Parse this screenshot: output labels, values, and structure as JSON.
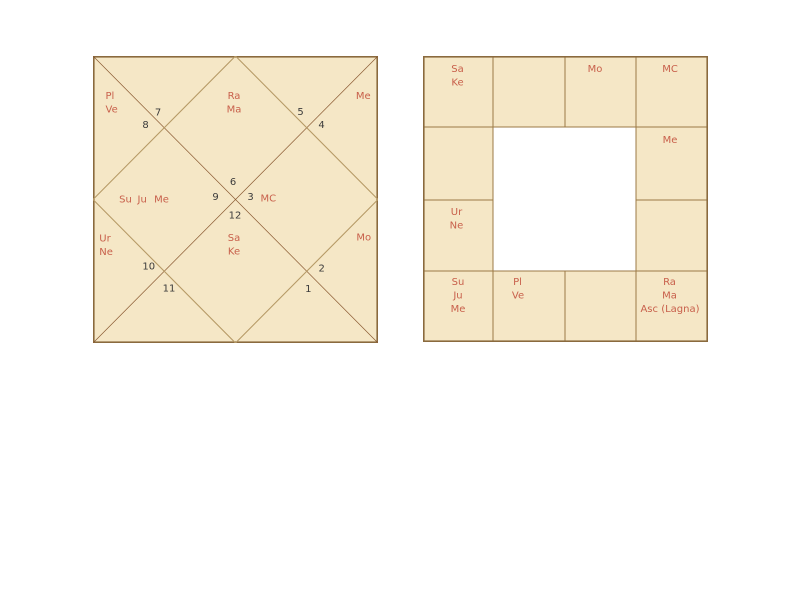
{
  "page": {
    "background": "#ffffff"
  },
  "colors": {
    "chart_fill": "#f5e7c6",
    "outer_border": "#8a6a3e",
    "grid_line": "#9b7a45",
    "diagonal_line": "#8a5a32",
    "rhombus_line": "#b69a66",
    "planet_text": "#c8604b",
    "number_text": "#3b3b3b"
  },
  "north_chart": {
    "house_numbers": {
      "h7": "7",
      "h8": "8",
      "h5": "5",
      "h4": "4",
      "h6": "6",
      "h9": "9",
      "h3": "3",
      "h12": "12",
      "h10": "10",
      "h11": "11",
      "h2": "2",
      "h1": "1"
    },
    "placements": {
      "top_left": [
        "Pl",
        "Ve"
      ],
      "top_center": [
        "Ra",
        "Ma"
      ],
      "top_right": [
        "Me"
      ],
      "left": [
        "Su",
        "Ju",
        "Me"
      ],
      "center_right": [
        "MC"
      ],
      "bottom_left": [
        "Ur",
        "Ne"
      ],
      "bottom_center": [
        "Sa",
        "Ke"
      ],
      "bottom_right": [
        "Mo"
      ]
    }
  },
  "south_chart": {
    "cells": {
      "r0c0": [
        "Sa",
        "Ke"
      ],
      "r0c2": [
        "Mo"
      ],
      "r0c3": [
        "MC"
      ],
      "r1c3": [
        "Me"
      ],
      "r2c0": [
        "Ur",
        "Ne"
      ],
      "r3c0": [
        "Su",
        "Ju",
        "Me"
      ],
      "r3c1": [
        "Pl",
        "Ve"
      ],
      "r3c3": [
        "Ra",
        "Ma",
        "Asc (Lagna)"
      ]
    }
  }
}
